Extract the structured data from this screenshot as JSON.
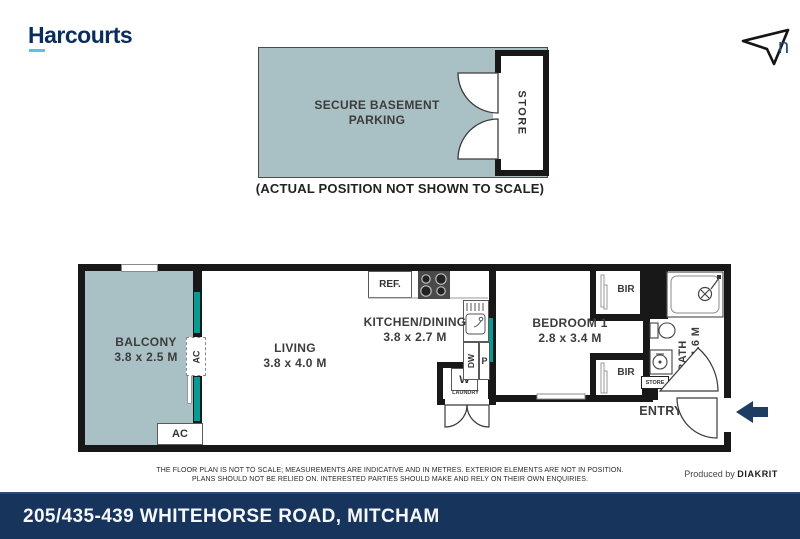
{
  "header": {
    "logo_text": "Harcourts",
    "logo_color": "#0b2d5c",
    "logo_underline_color": "#4fc6e9",
    "north_label": "n"
  },
  "parking": {
    "title": "SECURE BASEMENT PARKING",
    "store_label": "STORE",
    "caption": "(ACTUAL POSITION NOT SHOWN TO SCALE)",
    "fill_color": "#a9c0c4"
  },
  "plan": {
    "wall_color": "#181818",
    "glass_color": "#0a9a94",
    "rooms": {
      "balcony": {
        "name": "BALCONY",
        "dims": "3.8 x 2.5 M"
      },
      "living": {
        "name": "LIVING",
        "dims": "3.8 x 4.0 M"
      },
      "kitchen": {
        "name": "KITCHEN/DINING",
        "dims": "3.8 x 2.7 M"
      },
      "bedroom": {
        "name": "BEDROOM 1",
        "dims": "2.8 x 3.4 M"
      },
      "bath": {
        "name": "BATH",
        "dims": "2.6 x 1.6 M"
      },
      "entry": {
        "name": "ENTRY"
      }
    },
    "labels": {
      "ref": "REF.",
      "dw": "DW",
      "p": "P",
      "w": "W",
      "laundry": "LAUNDRY",
      "bir": "BIR",
      "store": "STORE",
      "ac": "AC"
    }
  },
  "footer": {
    "disclaimer_line1": "THE FLOOR PLAN IS NOT TO SCALE; MEASUREMENTS ARE INDICATIVE AND IN METRES. EXTERIOR ELEMENTS ARE NOT IN POSITION.",
    "disclaimer_line2": "PLANS SHOULD NOT BE RELIED ON. INTERESTED PARTIES SHOULD MAKE AND RELY ON THEIR OWN ENQUIRIES.",
    "produced_by": "Produced by",
    "producer": "DIAKRIT"
  },
  "address_bar": {
    "text": "205/435-439 WHITEHORSE ROAD, MITCHAM",
    "bg_color": "#16345c"
  }
}
